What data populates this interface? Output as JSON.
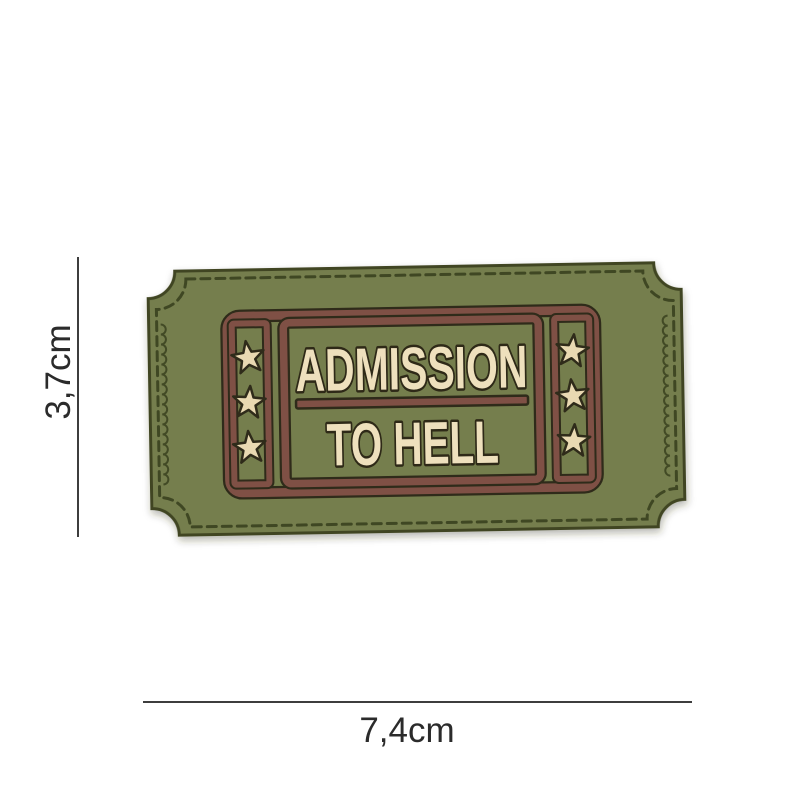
{
  "photo": {
    "background": "#ffffff"
  },
  "patch": {
    "line1": "ADMISSION",
    "line2": "TO HELL",
    "colors": {
      "green": "#747e4e",
      "green_edge": "#3f4522",
      "maroon": "#7f5045",
      "cream": "#eee0bd",
      "star": "#e9d9b2",
      "outline": "#2f2b1a",
      "stitch": "#3a411f"
    }
  },
  "dimensions": {
    "height_label": "3,7cm",
    "width_label": "7,4cm"
  }
}
